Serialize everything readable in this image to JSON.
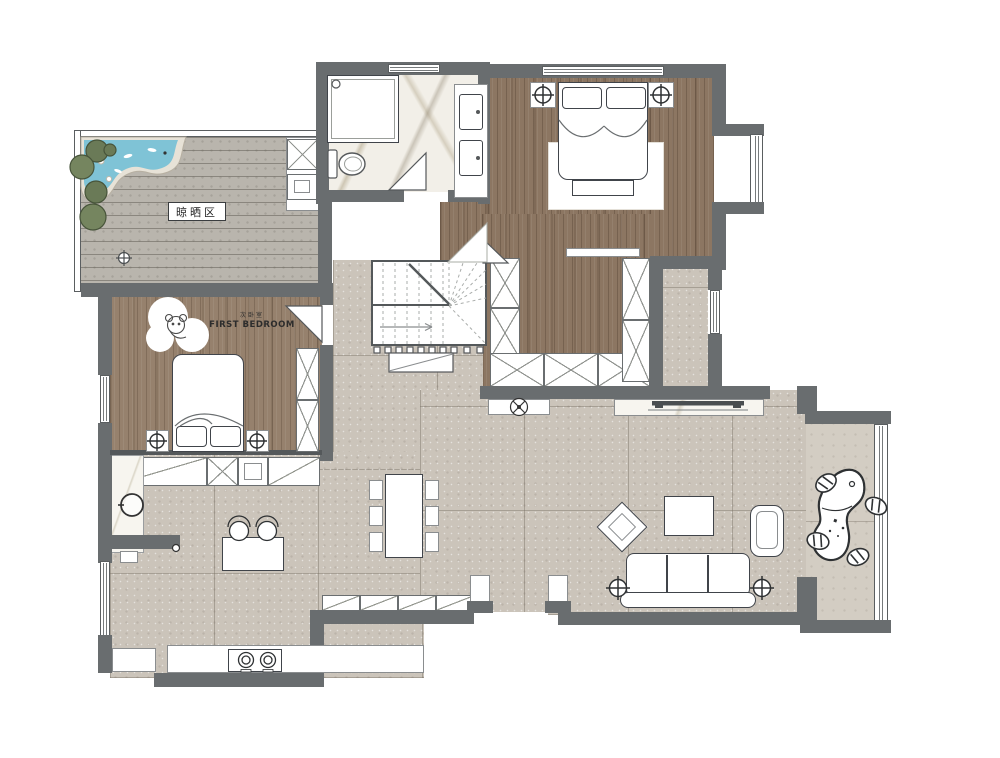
{
  "meta": {
    "title": "Residential interior floor plan (top view rendering)"
  },
  "labels": {
    "drying_area": "晾晒区",
    "first_bedroom_cn": "次卧室",
    "first_bedroom_en": "FIRST BEDROOM"
  },
  "colors": {
    "wall": "#696d6f",
    "wall_dark": "#54585a",
    "wood_floor": "#8c7662",
    "wood_floor_light": "#96816d",
    "tile_floor": "#cbc4ba",
    "tile_floor_light": "#d3cdc3",
    "deck_floor": "#b9b5ad",
    "marble_floor": "#f2efe8",
    "pond_water": "#7fc3d6",
    "plant_green": "#6a7a57",
    "outline_dark": "#40444a",
    "furniture_white": "#ffffff"
  },
  "icons": [
    "double-bed",
    "single-bed",
    "nightstand",
    "table-lamp",
    "wardrobe",
    "walk-in-closet",
    "sofa",
    "coffee-table",
    "armchair",
    "diamond-side-table",
    "tv-console",
    "dining-table",
    "dining-chair",
    "kitchen-table",
    "stove-burners",
    "sink-basin",
    "washing-machine",
    "laundry-sink",
    "toilet",
    "shower",
    "bathroom-vanity",
    "staircase",
    "stair-arrow",
    "pond-water-feature",
    "plant-bush",
    "leaf-stone",
    "lounge-chair",
    "ceiling-lamp",
    "floor-drain",
    "door-swing",
    "koala-rug"
  ]
}
